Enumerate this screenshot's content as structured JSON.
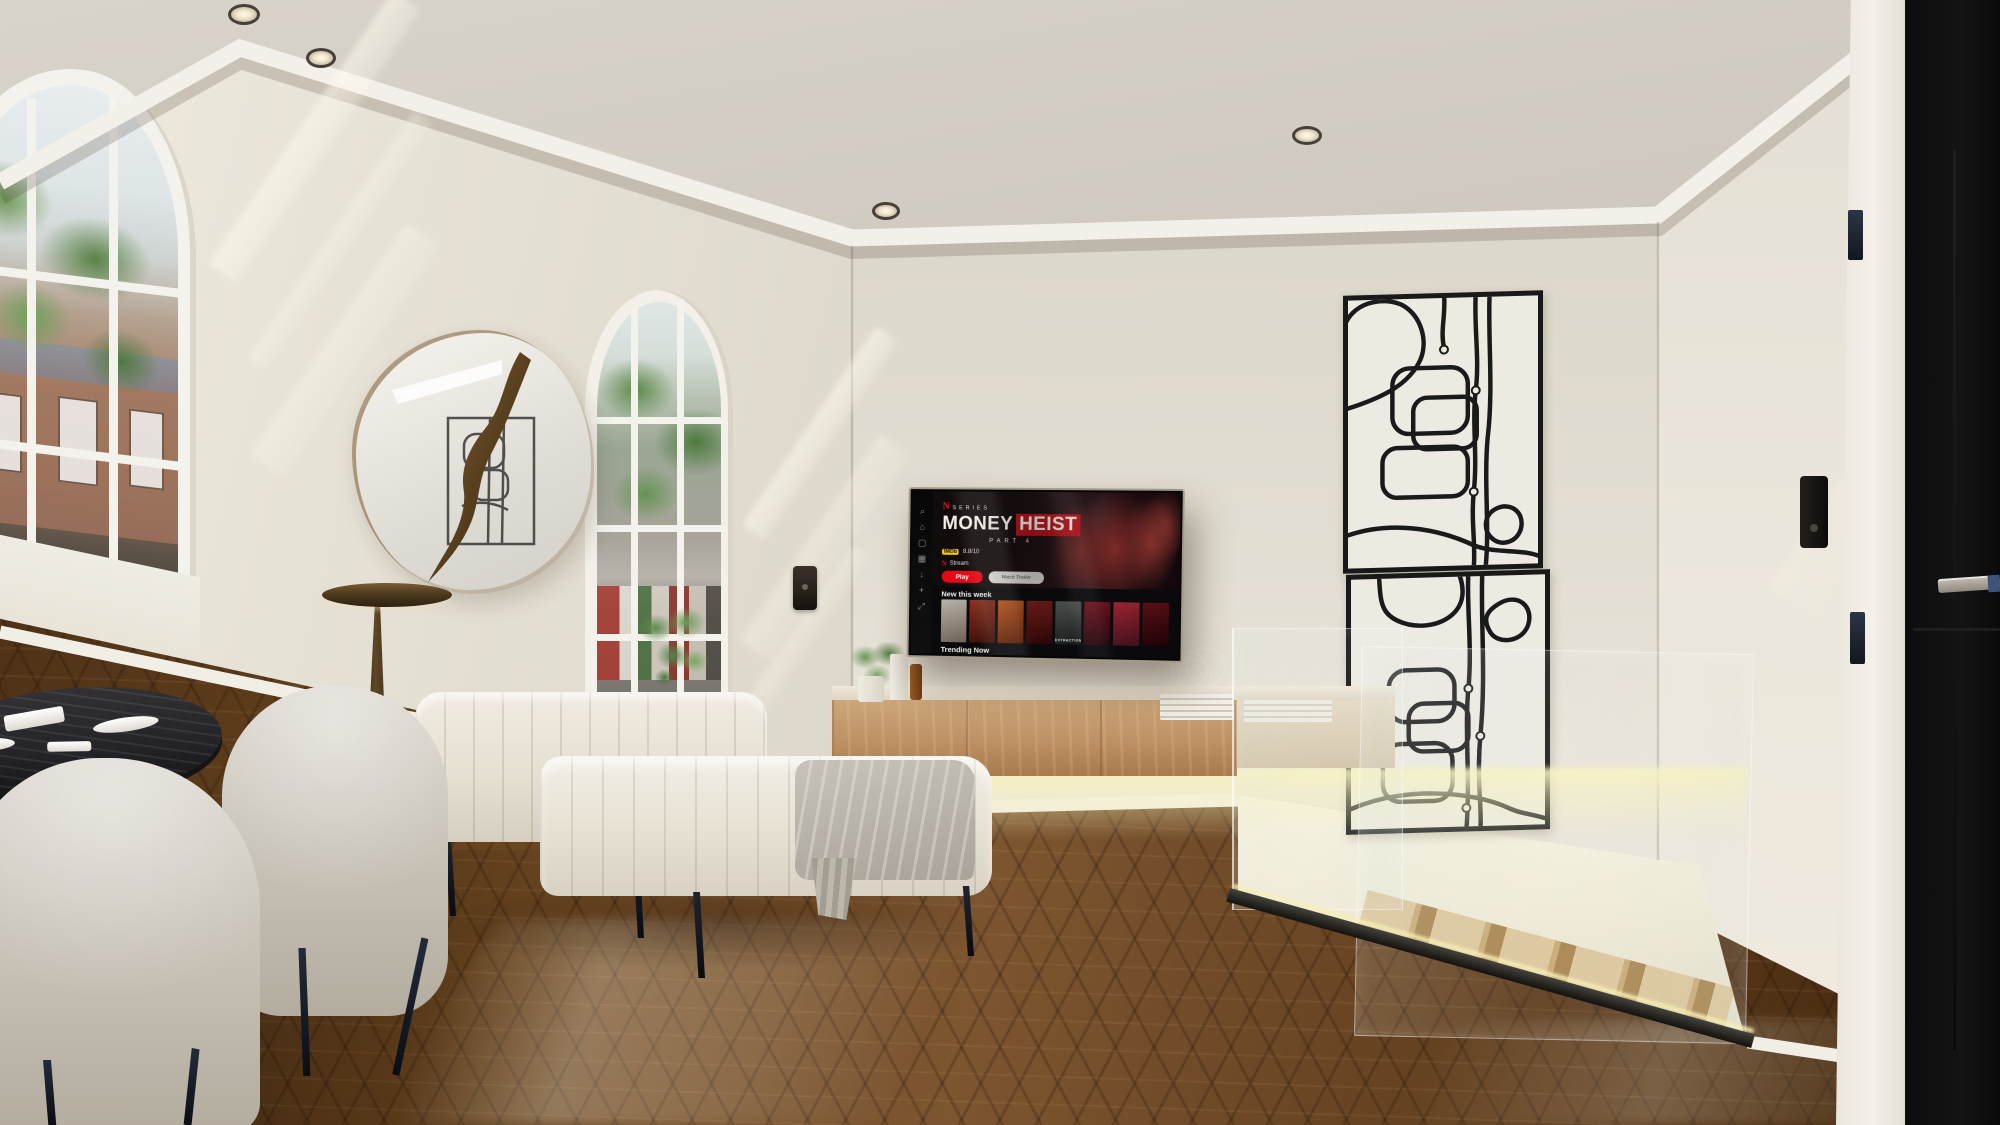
{
  "colors": {
    "wall": "#e4dfd4",
    "ceiling": "#d4cfc5",
    "floor_dark": "#4a2e15",
    "floor_light": "#7d5530",
    "console_wood": "#bd9164",
    "led_glow": "#f7f3be",
    "netflix_red": "#e50914",
    "heist_box_red": "#b6121b",
    "imdb_yellow": "#f5c518",
    "art_line": "#1a1a1a",
    "door_black": "#0c0c0d",
    "bronze": "#7a5a33",
    "upholstery": "#e9e4d9"
  },
  "tv": {
    "series_label": "SERIES",
    "n_glyph": "N",
    "title_word1": "MONEY",
    "title_word2": "HEIST",
    "subtitle": "PART 4",
    "imdb_label": "IMDb",
    "imdb_rating": "8.8/10",
    "stream_n": "N",
    "stream_label": "Stream",
    "play_label": "Play",
    "trailer_label": "Watch Trailer",
    "row1_label": "New this week",
    "row2_label": "Trending Now",
    "sidebar_icons": [
      {
        "name": "search",
        "glyph": "⌕"
      },
      {
        "name": "home",
        "glyph": "⌂"
      },
      {
        "name": "shows",
        "glyph": "▢"
      },
      {
        "name": "categories",
        "glyph": "▦"
      },
      {
        "name": "downloads",
        "glyph": "↓"
      },
      {
        "name": "my-list",
        "glyph": "+"
      },
      {
        "name": "expand",
        "glyph": "⤢"
      }
    ],
    "posters_row1": [
      {
        "c1": "#b8b2a8",
        "c2": "#6e6257",
        "label": ""
      },
      {
        "c1": "#8a2f1e",
        "c2": "#3a0f08",
        "label": ""
      },
      {
        "c1": "#c75b1e",
        "c2": "#5a1c08",
        "label": ""
      },
      {
        "c1": "#7e1f1a",
        "c2": "#2b0605",
        "label": ""
      },
      {
        "c1": "#565a56",
        "c2": "#15181a",
        "label": "EXTRACTION"
      },
      {
        "c1": "#6e1420",
        "c2": "#1f050a",
        "label": ""
      },
      {
        "c1": "#9a2430",
        "c2": "#40101c",
        "label": ""
      },
      {
        "c1": "#5a0f14",
        "c2": "#1c0306",
        "label": ""
      }
    ],
    "posters_row2": [
      {
        "c1": "#30424a",
        "c2": "#0e171c",
        "label": ""
      },
      {
        "c1": "#2e4a33",
        "c2": "#0d1a10",
        "label": ""
      },
      {
        "c1": "#13161c",
        "c2": "#05070c",
        "label": ""
      },
      {
        "c1": "#3a3126",
        "c2": "#120d07",
        "label": ""
      },
      {
        "c1": "#b5972f",
        "c2": "#4a3a0e",
        "label": ""
      },
      {
        "c1": "#23303c",
        "c2": "#0a1016",
        "label": ""
      },
      {
        "c1": "#402018",
        "c2": "#140906",
        "label": ""
      }
    ]
  }
}
